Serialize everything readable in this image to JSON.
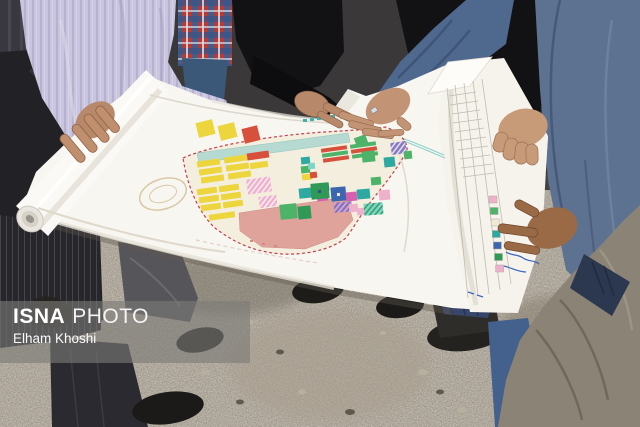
{
  "watermark": {
    "agency": "ISNA",
    "label": "PHOTO",
    "credit": "Elham Khoshi"
  },
  "colors": {
    "suit_blue": "#5c7290",
    "shirt_lavender": "#c9c5de",
    "plaid_red": "#b73a34",
    "plaid_blue": "#3a5f94",
    "olive_jacket": "#8b8375",
    "ground_gravel": "#8e8578",
    "paper_white": "#f8f6f1"
  },
  "plan": {
    "boundary_color": "#c2404e",
    "palette": {
      "yellow": "#edd53d",
      "red": "#d7503c",
      "green": "#4db369",
      "dgreen": "#2f9955",
      "teal": "#2ea9a1",
      "tealLight": "#b6dad2",
      "cyan": "#7fd4c8",
      "magenta": "#d65fae",
      "pink": "#efb0cc",
      "salmon": "#e0a39c",
      "blue": "#3c66ad",
      "navy": "#2e4f8f",
      "purple": "#8677c0",
      "cream": "#f0e8d2"
    },
    "parcels": [
      {
        "x": 197,
        "y": 160,
        "w": 23,
        "h": 6,
        "c": "yellow",
        "r": -8
      },
      {
        "x": 199,
        "y": 168,
        "w": 23,
        "h": 6,
        "c": "yellow",
        "r": -8
      },
      {
        "x": 201,
        "y": 176,
        "w": 23,
        "h": 6,
        "c": "yellow",
        "r": -8
      },
      {
        "x": 224,
        "y": 156,
        "w": 23,
        "h": 6,
        "c": "yellow",
        "r": -8
      },
      {
        "x": 226,
        "y": 164,
        "w": 23,
        "h": 6,
        "c": "yellow",
        "r": -8
      },
      {
        "x": 228,
        "y": 172,
        "w": 23,
        "h": 6,
        "c": "yellow",
        "r": -8
      },
      {
        "x": 247,
        "y": 152,
        "w": 22,
        "h": 7,
        "c": "red",
        "r": -8
      },
      {
        "x": 250,
        "y": 162,
        "w": 18,
        "h": 6,
        "c": "yellow",
        "r": -8
      },
      {
        "x": 197,
        "y": 188,
        "w": 20,
        "h": 6,
        "c": "yellow",
        "r": -8
      },
      {
        "x": 199,
        "y": 196,
        "w": 20,
        "h": 6,
        "c": "yellow",
        "r": -8
      },
      {
        "x": 201,
        "y": 204,
        "w": 20,
        "h": 6,
        "c": "yellow",
        "r": -8
      },
      {
        "x": 219,
        "y": 185,
        "w": 20,
        "h": 6,
        "c": "yellow",
        "r": -8
      },
      {
        "x": 221,
        "y": 193,
        "w": 20,
        "h": 6,
        "c": "yellow",
        "r": -8
      },
      {
        "x": 223,
        "y": 201,
        "w": 20,
        "h": 6,
        "c": "yellow",
        "r": -8
      },
      {
        "x": 209,
        "y": 213,
        "w": 26,
        "h": 6,
        "c": "yellow",
        "r": -8
      },
      {
        "x": 247,
        "y": 178,
        "w": 24,
        "h": 15,
        "c": "pink",
        "r": -8,
        "p": "hatchPink"
      },
      {
        "x": 259,
        "y": 196,
        "w": 18,
        "h": 11,
        "c": "pink",
        "r": -8,
        "p": "hatchPink"
      },
      {
        "x": 280,
        "y": 204,
        "w": 17,
        "h": 15,
        "c": "green",
        "r": -6
      },
      {
        "x": 298,
        "y": 206,
        "w": 13,
        "h": 13,
        "c": "dgreen",
        "r": -6
      },
      {
        "x": 299,
        "y": 188,
        "w": 15,
        "h": 10,
        "c": "teal",
        "r": -6
      },
      {
        "x": 318,
        "y": 183,
        "w": 11,
        "h": 8,
        "c": "navy",
        "r": -6
      },
      {
        "x": 317,
        "y": 193,
        "w": 11,
        "h": 8,
        "c": "magenta",
        "r": -6
      },
      {
        "x": 321,
        "y": 147,
        "w": 26,
        "h": 4,
        "c": "red",
        "r": -8
      },
      {
        "x": 322,
        "y": 152,
        "w": 26,
        "h": 4,
        "c": "green",
        "r": -8
      },
      {
        "x": 323,
        "y": 157,
        "w": 26,
        "h": 4,
        "c": "red",
        "r": -8
      },
      {
        "x": 350,
        "y": 143,
        "w": 26,
        "h": 4,
        "c": "green",
        "r": -8
      },
      {
        "x": 351,
        "y": 148,
        "w": 26,
        "h": 4,
        "c": "red",
        "r": -8
      },
      {
        "x": 352,
        "y": 153,
        "w": 26,
        "h": 4,
        "c": "green",
        "r": -8
      },
      {
        "x": 362,
        "y": 151,
        "w": 13,
        "h": 11,
        "c": "green",
        "r": -6
      },
      {
        "x": 384,
        "y": 157,
        "w": 11,
        "h": 10,
        "c": "teal",
        "r": -6
      },
      {
        "x": 391,
        "y": 142,
        "w": 15,
        "h": 12,
        "c": "purple",
        "r": -8,
        "p": "hatchPink"
      },
      {
        "x": 404,
        "y": 151,
        "w": 8,
        "h": 8,
        "c": "green",
        "r": -6
      },
      {
        "x": 355,
        "y": 136,
        "w": 12,
        "h": 9,
        "c": "green",
        "r": -20
      },
      {
        "x": 301,
        "y": 157,
        "w": 9,
        "h": 7,
        "c": "teal",
        "r": -6
      },
      {
        "x": 301,
        "y": 166,
        "w": 9,
        "h": 7,
        "c": "green",
        "r": -6
      },
      {
        "x": 302,
        "y": 174,
        "w": 10,
        "h": 6,
        "c": "yellow",
        "r": -6
      },
      {
        "x": 308,
        "y": 163,
        "w": 7,
        "h": 6,
        "c": "cyan",
        "r": -6
      },
      {
        "x": 310,
        "y": 172,
        "w": 7,
        "h": 6,
        "c": "red",
        "r": -6
      },
      {
        "x": 311,
        "y": 183,
        "w": 18,
        "h": 16,
        "c": "dgreen",
        "r": -5
      },
      {
        "x": 318,
        "y": 190,
        "w": 3,
        "h": 3,
        "c": "navy",
        "r": -5
      },
      {
        "x": 331,
        "y": 187,
        "w": 15,
        "h": 14,
        "c": "blue",
        "r": -5
      },
      {
        "x": 337,
        "y": 193,
        "w": 3,
        "h": 3,
        "c": "cream",
        "r": -5
      },
      {
        "x": 346,
        "y": 192,
        "w": 11,
        "h": 9,
        "c": "magenta",
        "r": -5
      },
      {
        "x": 334,
        "y": 202,
        "w": 18,
        "h": 10,
        "c": "purple",
        "r": -5,
        "p": "hatchBlue"
      },
      {
        "x": 349,
        "y": 204,
        "w": 9,
        "h": 8,
        "c": "pink",
        "r": -5
      },
      {
        "x": 357,
        "y": 208,
        "w": 8,
        "h": 7,
        "c": "pink",
        "r": -5
      },
      {
        "x": 357,
        "y": 189,
        "w": 13,
        "h": 10,
        "c": "teal",
        "r": -5
      },
      {
        "x": 364,
        "y": 203,
        "w": 19,
        "h": 12,
        "c": "cyan",
        "r": -5,
        "p": "hatchGreen"
      },
      {
        "x": 379,
        "y": 190,
        "w": 11,
        "h": 10,
        "c": "pink",
        "r": -5
      },
      {
        "x": 371,
        "y": 177,
        "w": 10,
        "h": 8,
        "c": "green",
        "r": -5
      },
      {
        "x": 197,
        "y": 121,
        "w": 17,
        "h": 15,
        "c": "yellow",
        "r": -14
      },
      {
        "x": 219,
        "y": 124,
        "w": 17,
        "h": 15,
        "c": "yellow",
        "r": -14
      },
      {
        "x": 243,
        "y": 127,
        "w": 16,
        "h": 15,
        "c": "red",
        "r": -14
      }
    ],
    "legend": {
      "x": 489,
      "y": 196,
      "step": 11.5,
      "w": 8,
      "h": 7,
      "colors": [
        "pink",
        "green",
        "cream",
        "teal",
        "blue",
        "dgreen",
        "pink"
      ]
    }
  }
}
